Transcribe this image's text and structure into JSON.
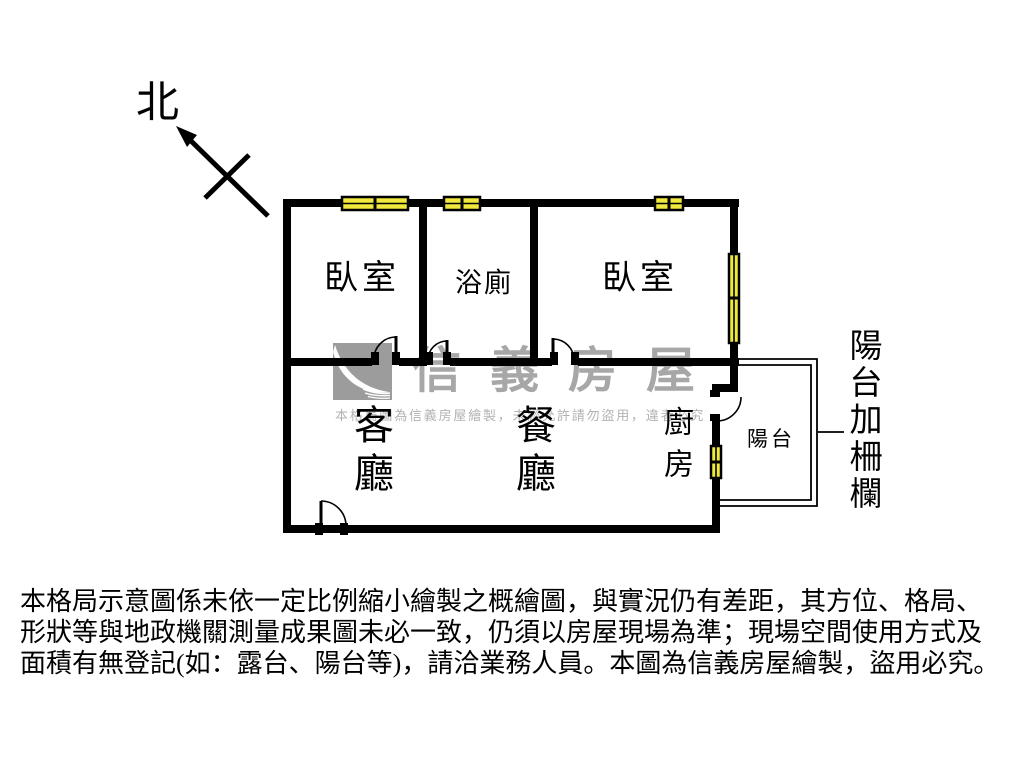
{
  "compass": {
    "label": "北"
  },
  "rooms": {
    "bedroom1": "臥室",
    "bathroom": "浴廁",
    "bedroom2": "臥室",
    "living": "客廳",
    "dining": "餐廳",
    "kitchen": "廚房",
    "balcony": "陽台",
    "balcony_annotation": "陽台加柵欄"
  },
  "watermark": {
    "brand": "信義房屋",
    "notice": "本格局圖為信義房屋繪製，未經允許請勿盜用，違者必究"
  },
  "disclaimer": {
    "lines": [
      "本格局示意圖係未依一定比例縮小繪製之概繪圖，與實況仍有差距，其方位、格局、",
      "形狀等與地政機關測量成果圖未必一致，仍須以房屋現場為準；現場空間使用方式及",
      "面積有無登記(如：露台、陽台等)，請洽業務人員。本圖為信義房屋繪製，盜用必究。"
    ]
  },
  "colors": {
    "wall": "#000000",
    "window_fill": "#f0e83c",
    "watermark_gray": "#a7a7a7"
  }
}
